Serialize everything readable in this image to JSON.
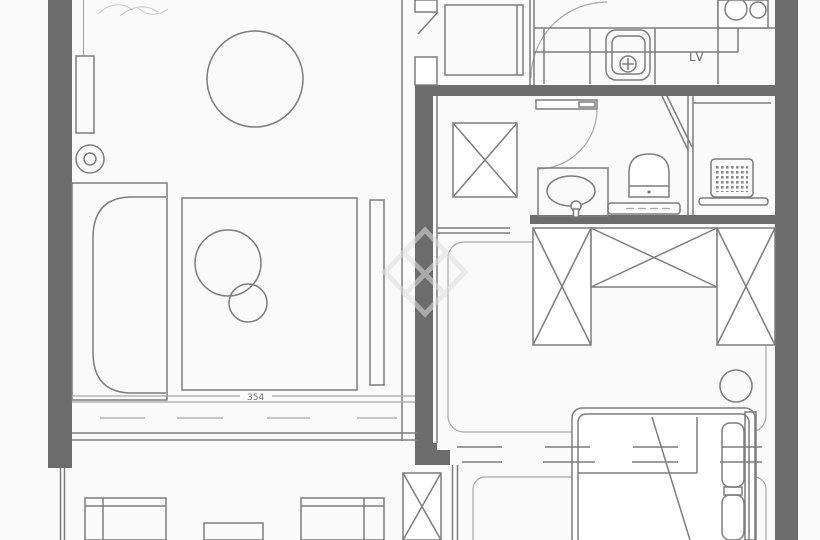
{
  "plan": {
    "title": "apartment-floor-plan",
    "labels": {
      "kitchen_appliance": "LV",
      "dimension": "354"
    },
    "colors": {
      "background": "#fafafa",
      "wall_fill": "#6c6c6c",
      "line": "#7d7d7d",
      "line_light": "#a8a8a8",
      "text": "#6f6f6f",
      "watermark": "#dedede"
    }
  }
}
